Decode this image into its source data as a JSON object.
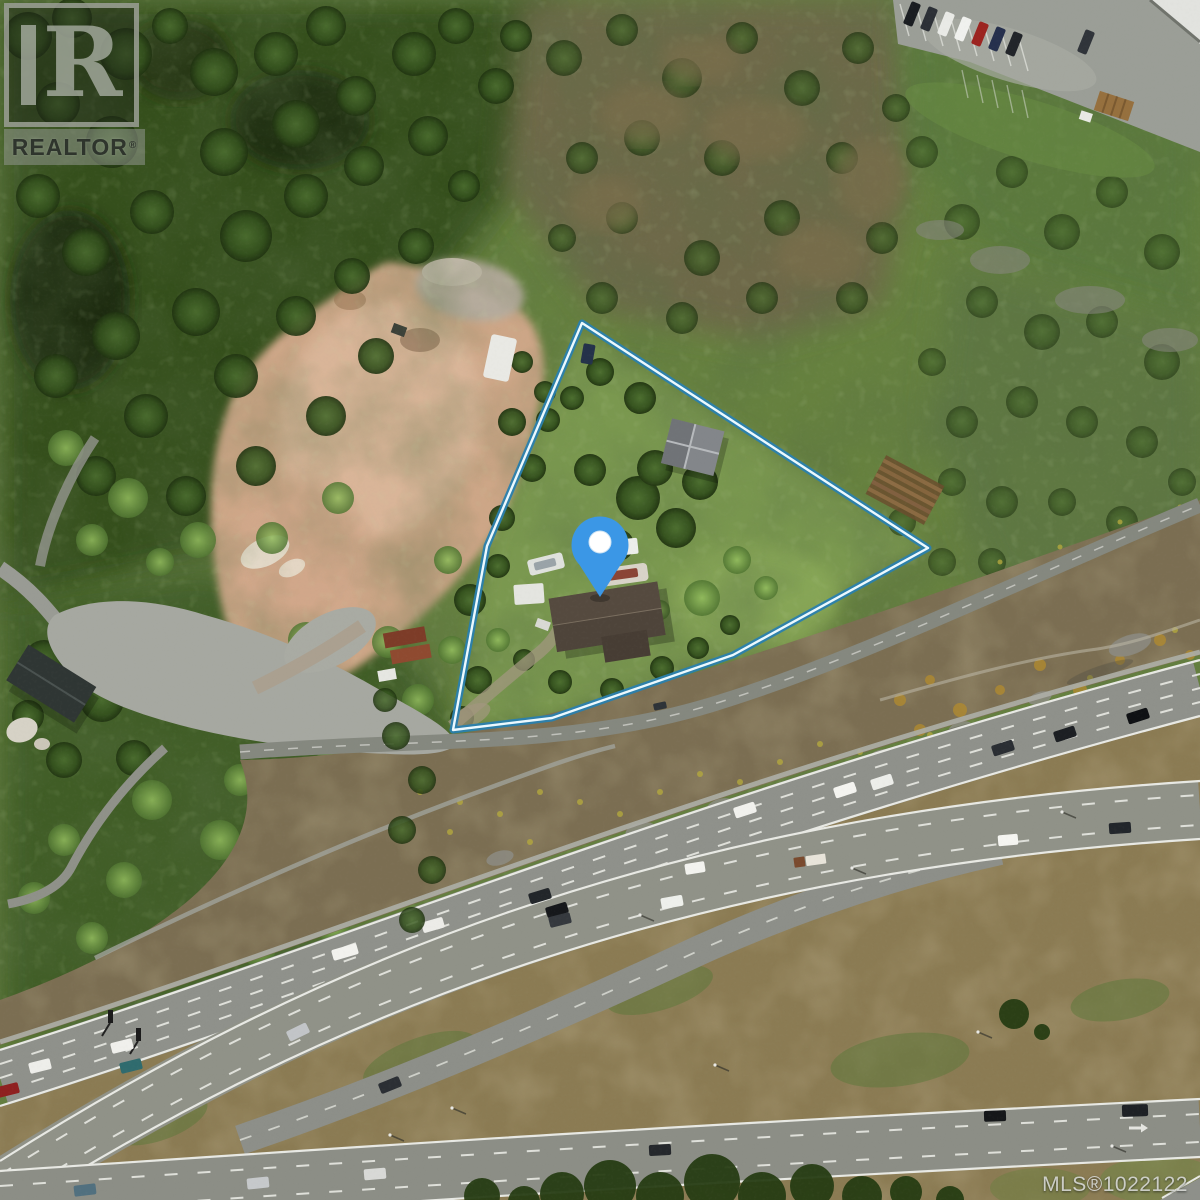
{
  "photo": {
    "description": "Aerial satellite photo of a treed property beside a highway interchange"
  },
  "watermarks": {
    "realtor": {
      "letter": "R",
      "wordmark": "REALTOR",
      "registered_mark": "®"
    },
    "mls": {
      "text": "MLS®1022122"
    }
  },
  "overlay": {
    "boundary": {
      "points": "582,323 928,548 733,655 552,718 453,730 487,546",
      "outer_color": "#2a7fae",
      "inner_color": "#ecf9fe"
    },
    "pin": {
      "fill": "#3b97e6",
      "dot_color": "#ffffff"
    }
  }
}
